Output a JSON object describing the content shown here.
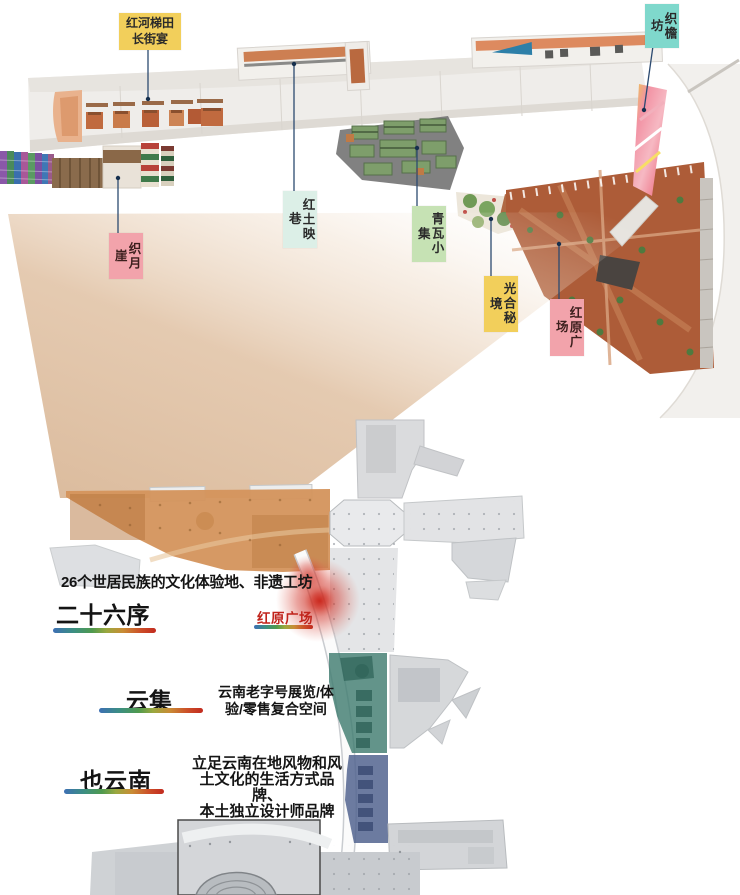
{
  "map_labels": {
    "changjieyan": {
      "line1": "红河梯田",
      "line2": "长街宴"
    },
    "zhiyanfang": "织檐坊",
    "zhiyueya": "织月崖",
    "hongtuyingxiang": "红土映巷",
    "qingwaxiaoji": "青瓦小集",
    "guanghemijing": "光合秘境",
    "hongyuanguangchang": "红原广场"
  },
  "sections": {
    "ershiliuxu": {
      "description": "26个世居民族的文化体验地、非遗工坊",
      "title": "二十六序",
      "plaza_label": "红原广场"
    },
    "yunji": {
      "title": "云集",
      "description_lines": [
        "云南老字号展览/体",
        "验/零售复合空间"
      ]
    },
    "yeyunnan": {
      "title": "也云南",
      "description_lines": [
        "立足云南在地风物和风",
        "土文化的生活方式品牌、",
        "本土独立设计师品牌"
      ]
    }
  },
  "colors": {
    "tag_yellow": "#f2cf5b",
    "tag_mint": "#dcefe7",
    "tag_green": "#c6e2b4",
    "tag_pink": "#f2a3ab",
    "tag_teal": "#7fd8cc",
    "accent_red": "#c0241c",
    "zone_orange": "#d4945c",
    "zone_teal": "#417d70",
    "zone_blue": "#52648f",
    "cone_tan": "#dcbda0",
    "plaza_terracotta": "#ad5c38"
  }
}
